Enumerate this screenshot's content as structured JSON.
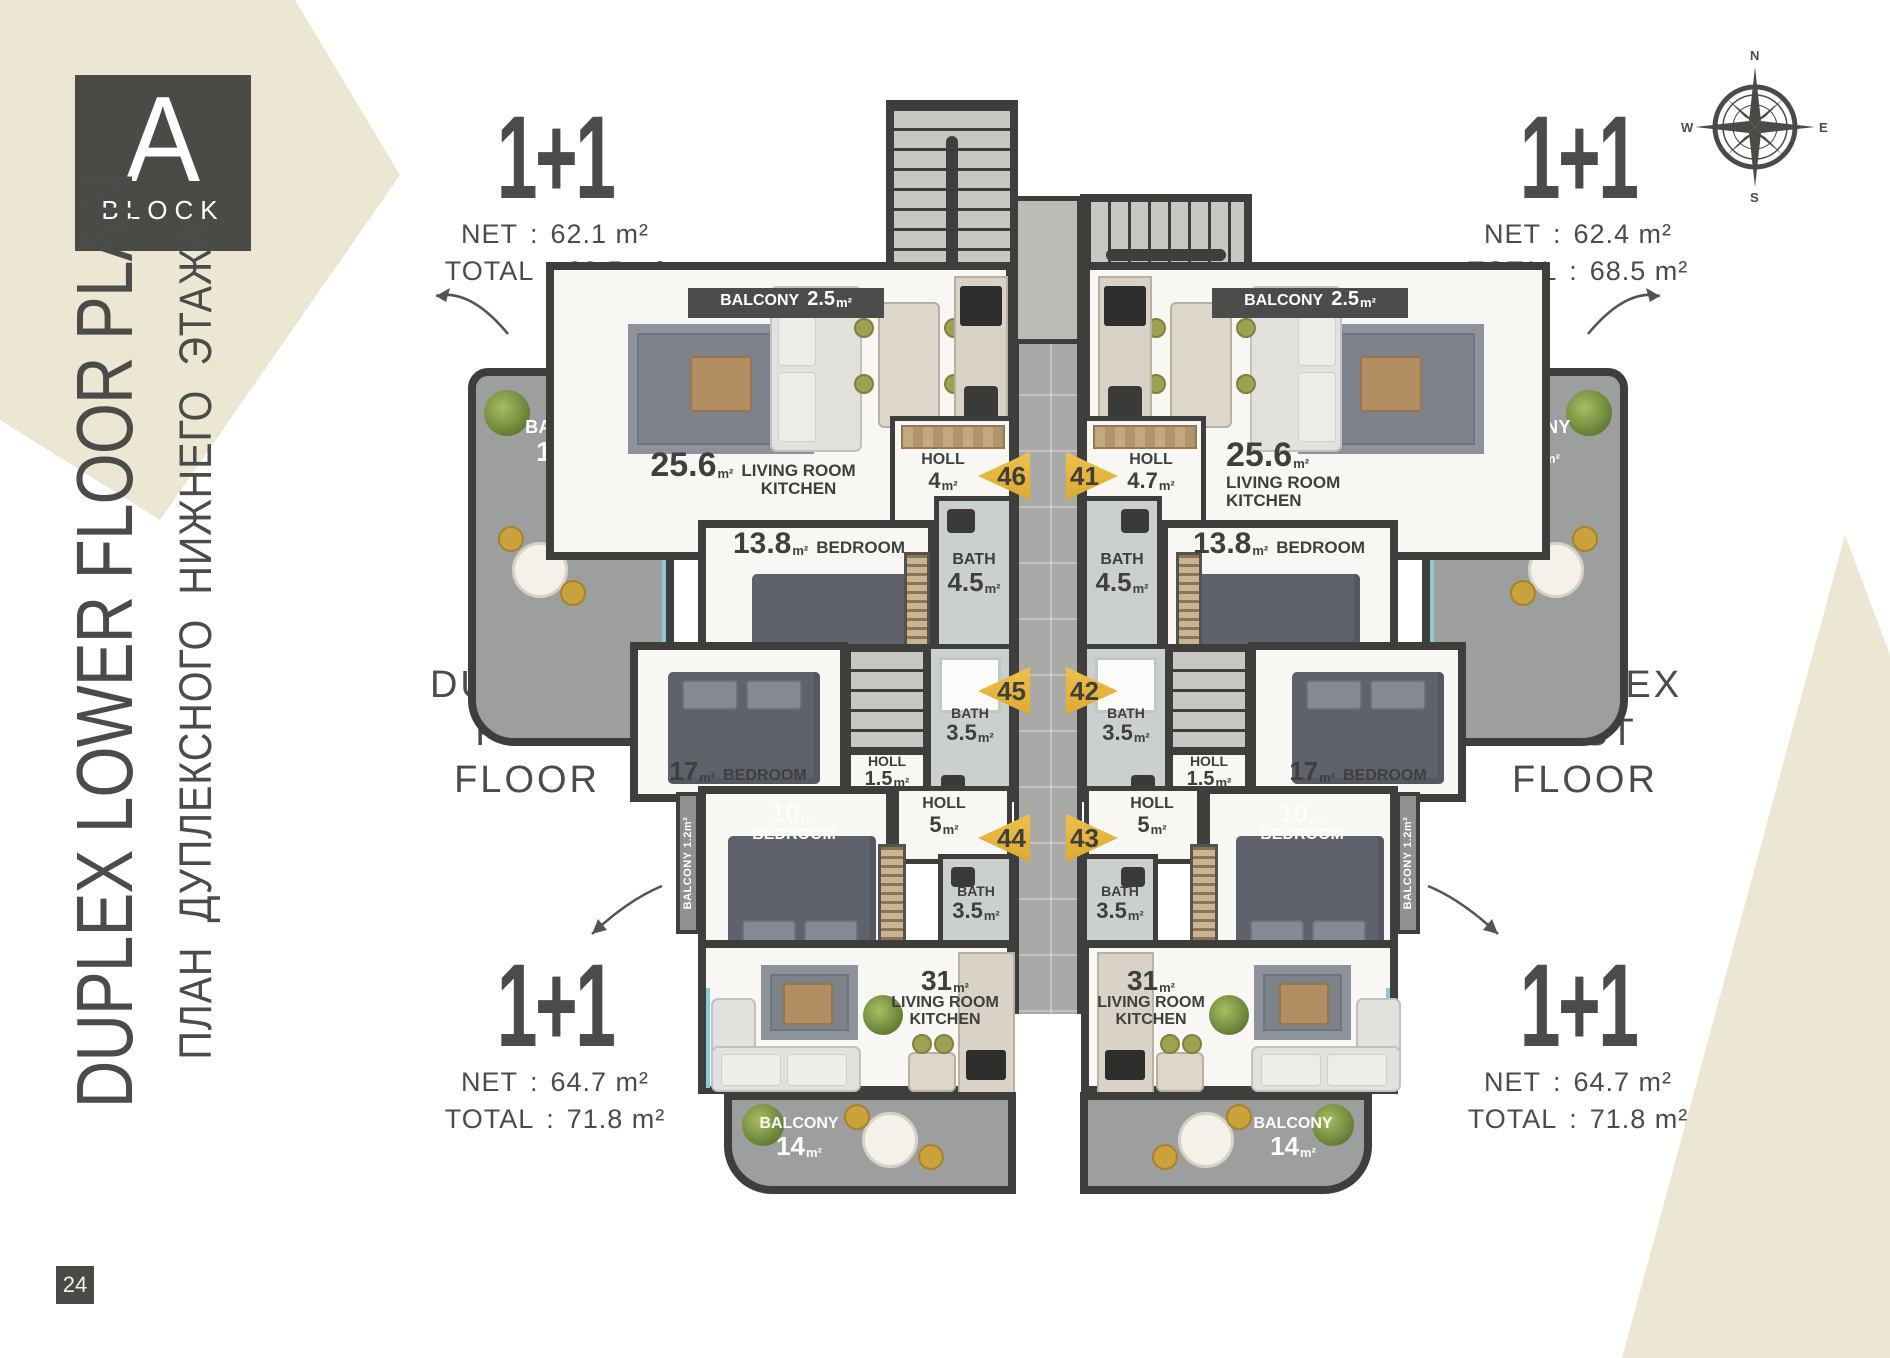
{
  "page_number": "24",
  "block_badge": {
    "letter": "A",
    "word": "BLOCK"
  },
  "titles": {
    "en": "DUPLEX LOWER FLOOR PLAN",
    "ru": "ПЛАН ДУПЛЕКСНОГО НИЖНЕГО ЭТАЖА"
  },
  "compass": {
    "n": "N",
    "e": "E",
    "s": "S",
    "w": "W"
  },
  "colon": ":",
  "m2": "m²",
  "labels": {
    "elevator": "ELEVATOR",
    "net": "NET",
    "total": "TOTAL",
    "duplex_line1": "DUPLEX",
    "duplex_line2": "FIRST FLOOR",
    "balcony": "BALCONY",
    "bath": "BATH",
    "holl": "HOLL",
    "bedroom": "BEDROOM",
    "living_room": "LIVING ROOM",
    "kitchen": "KITCHEN"
  },
  "units": {
    "top_left": {
      "type": "1+1",
      "net": "62.1 m²",
      "total": "68.5 m²"
    },
    "top_right": {
      "type": "1+1",
      "net": "62.4 m²",
      "total": "68.5 m²"
    },
    "bottom_left": {
      "type": "1+1",
      "net": "64.7 m²",
      "total": "71.8 m²"
    },
    "bottom_right": {
      "type": "1+1",
      "net": "64.7 m²",
      "total": "71.8 m²"
    }
  },
  "apartment_numbers": {
    "tl": "46",
    "tr": "41",
    "ml": "45",
    "mr": "42",
    "bl": "44",
    "br": "43"
  },
  "rooms": {
    "living_top": {
      "area": "25.6"
    },
    "holl_tl": {
      "area": "4"
    },
    "holl_tr": {
      "area": "4.7"
    },
    "bedroom_top": {
      "area": "13.8"
    },
    "bath_top": {
      "area": "4.5"
    },
    "balcony_side": {
      "area": "11.5"
    },
    "balcony_top": {
      "area": "2.5"
    },
    "bedroom_mid": {
      "area": "17"
    },
    "holl_mid": {
      "area": "1.5"
    },
    "bath_mid": {
      "area": "3.5"
    },
    "bedroom_low": {
      "area": "10"
    },
    "holl_low": {
      "area": "5"
    },
    "bath_low": {
      "area": "3.5"
    },
    "living_low": {
      "area": "31"
    },
    "balcony_low": {
      "area": "14"
    },
    "balcony_strip": {
      "area": "1.2"
    }
  }
}
